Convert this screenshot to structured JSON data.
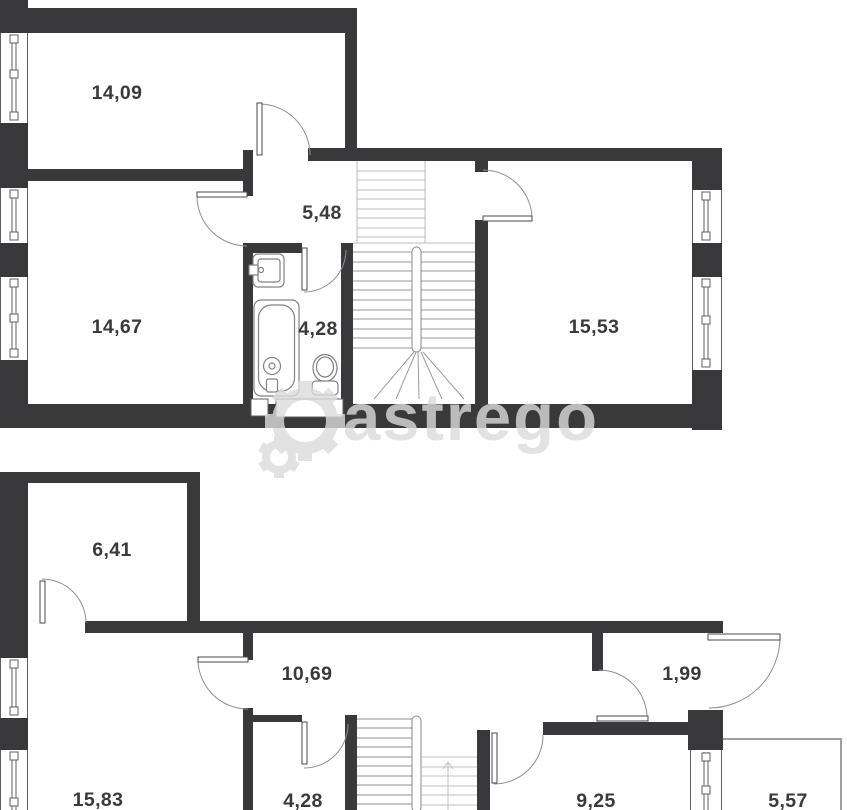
{
  "document": {
    "type": "floor-plan",
    "floor_count": 2
  },
  "watermark": {
    "text": "astrego"
  },
  "floors": [
    {
      "name": "upper-level",
      "rooms": [
        {
          "area": "14,09"
        },
        {
          "area": "5,48"
        },
        {
          "area": "14,67"
        },
        {
          "area": "4,28"
        },
        {
          "area": "15,53"
        }
      ]
    },
    {
      "name": "lower-level",
      "rooms": [
        {
          "area": "6,41"
        },
        {
          "area": "10,69"
        },
        {
          "area": "1,99"
        },
        {
          "area": "15,83"
        },
        {
          "area": "4,28"
        },
        {
          "area": "9,25"
        },
        {
          "area": "5,57"
        }
      ]
    }
  ],
  "colors": {
    "wall": "#39393b",
    "thin_line": "#5f5f5f",
    "door_arc": "#8f8f8f",
    "stair_dark": "#8f8f8f",
    "stair_light": "#c0c0c0",
    "label": "#3a3a3c",
    "watermark": "#dcdcdc",
    "background": "#ffffff"
  }
}
